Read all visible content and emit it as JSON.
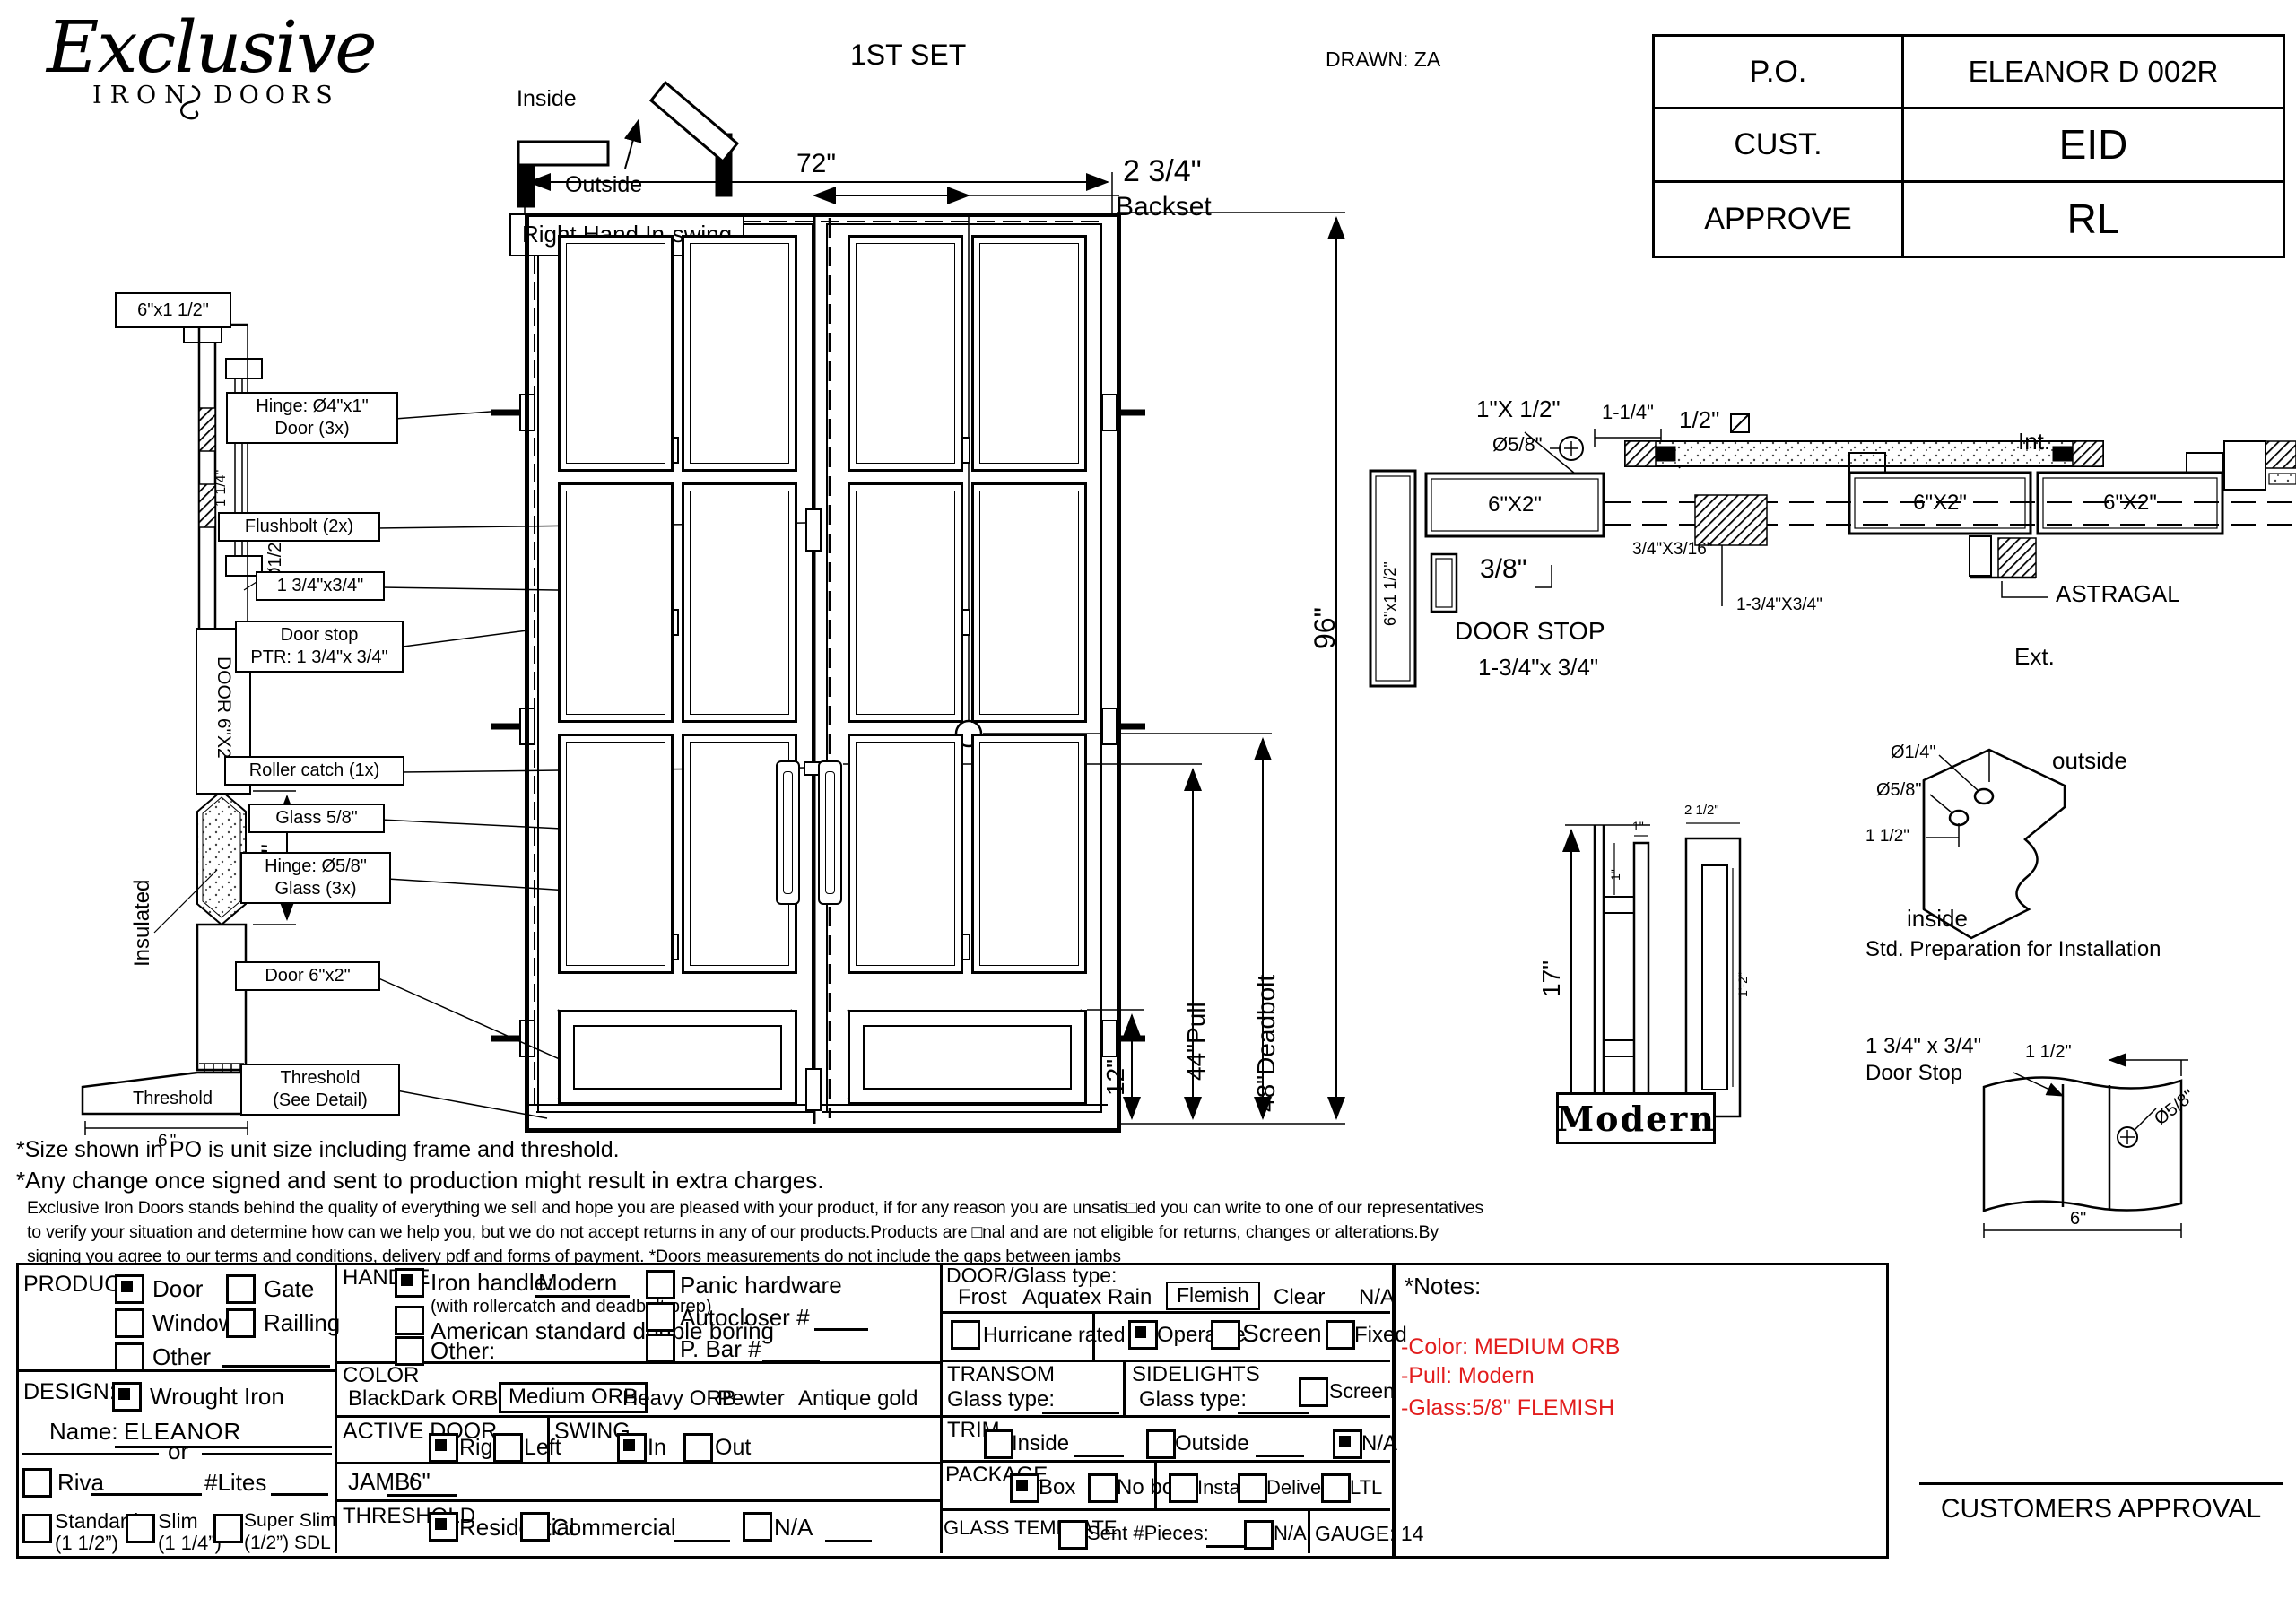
{
  "header": {
    "logo": {
      "script": "Exclusive",
      "word1": "IRON",
      "word2": "DOORS"
    },
    "set_label": "1ST SET",
    "drawn_label": "DRAWN: ZA",
    "po_table": {
      "rows": [
        {
          "label": "P.O.",
          "value": "ELEANOR D 002R"
        },
        {
          "label": "CUST.",
          "value": "EID"
        },
        {
          "label": "APPROVE",
          "value": "RL"
        }
      ]
    },
    "swing": {
      "inside": "Inside",
      "outside": "Outside",
      "caption": "Right Hand In-swing"
    }
  },
  "side_view": {
    "frame_label": "6\"x1 1/2\"",
    "dim_small": "1 1/4\"",
    "dim_dia": "Ø1/2\"",
    "door_label": "DOOR 6\"X2\"",
    "insulated_label": "Insulated",
    "dim_12": "12\"",
    "threshold_label": "Threshold",
    "threshold_dim": "6\""
  },
  "elevation": {
    "dim_width": "72\"",
    "backset_value": "2 3/4\"",
    "backset_label": "Backset",
    "dim_height": "96\"",
    "dim_deadbolt": "48\"Deadbolt",
    "dim_pull": "44\"Pull",
    "dim_bottom": "12\"",
    "callouts": [
      {
        "l1": "Hinge: Ø4\"x1\"",
        "l2": "Door (3x)"
      },
      {
        "l1": "Flushbolt (2x)",
        "l2": ""
      },
      {
        "l1": "1 3/4\"x3/4\"",
        "l2": ""
      },
      {
        "l1": "Door stop",
        "l2": "PTR: 1 3/4\"x 3/4\""
      },
      {
        "l1": "Roller catch  (1x)",
        "l2": ""
      },
      {
        "l1": "Glass 5/8\"",
        "l2": ""
      },
      {
        "l1": "Hinge: Ø5/8\"",
        "l2": "Glass (3x)"
      },
      {
        "l1": "Door 6\"x2\"",
        "l2": ""
      },
      {
        "l1": "Threshold",
        "l2": "(See Detail)"
      }
    ]
  },
  "plan_view": {
    "jamb_label": "6\"x1 1/2\"",
    "head_label": "6\"X2\"",
    "dim_1x": "1\"X 1/2\"",
    "dim_dia58": "Ø5/8\"",
    "dim_114": "1-1/4\"",
    "dim_half": "1/2\"",
    "dim_38": "3/8\"",
    "door_stop_l1": "DOOR STOP",
    "door_stop_l2": "1-3/4\"x 3/4\"",
    "dim_316": "3/4\"X3/16\"",
    "dim_134": "1-3/4\"X3/4\"",
    "int_label": "Int.",
    "ext_label": "Ext.",
    "leaf_label_left": "6\"X2\"",
    "leaf_label_right": "6\"X2\"",
    "astragal_label": "ASTRAGAL"
  },
  "pull_detail": {
    "dim_height": "17\"",
    "dim_one_a": "1\"",
    "dim_one_b": "1\"",
    "dim_width": "2 1/2\"",
    "dim_length": "1'-2\"",
    "name": "Modern"
  },
  "prep_detail": {
    "dia_small": "Ø1/4\"",
    "dia_big": "Ø5/8\"",
    "dim": "1 1/2\"",
    "outside": "outside",
    "inside": "inside",
    "caption": "Std. Preparation for Installation"
  },
  "stop_detail": {
    "label_l1": "1 3/4\" x 3/4\"",
    "label_l2": "Door Stop",
    "dim_a": "1 1/2\"",
    "dim_dia": "Ø5/8\"",
    "dim_w": "6\""
  },
  "disclaimers": {
    "line1": "*Size shown in PO is unit size including frame and threshold.",
    "line2": "*Any change once signed and sent to production might result in extra charges.",
    "para": "Exclusive Iron Doors stands behind the quality of everything we sell and hope you are pleased with your product, if for any reason you are unsatis□ed you can write to one of our representatives to verify your situation and determine how can we help you, but we do not accept returns in any of our products.Products are □nal and are not eligible for returns, changes or alterations.By signing you agree to our terms and conditions, delivery pdf and forms of payment. *Doors measurements do not include the gaps between jambs"
  },
  "form": {
    "product": {
      "title": "PRODUCT:",
      "door": {
        "label": "Door",
        "checked": true
      },
      "gate": {
        "label": "Gate",
        "checked": false
      },
      "window": {
        "label": "Window",
        "checked": false
      },
      "railling": {
        "label": "Railling",
        "checked": false
      },
      "other": {
        "label": "Other",
        "checked": false
      }
    },
    "design": {
      "title": "DESIGN:",
      "wrought": {
        "label": "Wrought Iron",
        "checked": true
      },
      "name_label": "Name:",
      "name_value": "ELEANOR",
      "or_label": "or",
      "riva": {
        "label": "Riva",
        "checked": false
      },
      "lites_label": "#Lites",
      "standard": {
        "l1": "Standard",
        "l2": "(1 1/2”)",
        "checked": false
      },
      "slim": {
        "l1": "Slim",
        "l2": "(1 1/4”)",
        "checked": false
      },
      "superslim": {
        "l1": "Super Slim",
        "l2": "(1/2”) SDL",
        "checked": false
      }
    },
    "handle": {
      "title": "HANDLE",
      "iron": {
        "label": "Iron handle:",
        "value": "Modern",
        "sub": "(with rollercatch and deadbolt prep)",
        "checked": true
      },
      "american": {
        "label": "American standard double boring",
        "checked": false
      },
      "other": {
        "label": "Other:",
        "checked": false
      },
      "panic": {
        "label": "Panic hardware",
        "checked": false
      },
      "autocloser": {
        "label": "Autocloser #",
        "checked": false
      },
      "pbar": {
        "label": "P. Bar #",
        "checked": false
      }
    },
    "color": {
      "title": "COLOR",
      "options": [
        "Black",
        "Dark ORB",
        "Medium ORB",
        "Heavy ORB",
        "Pewter",
        "Antique gold"
      ],
      "selected": "Medium ORB"
    },
    "active_door": {
      "title": "ACTIVE DOOR",
      "right": {
        "label": "Right",
        "checked": true
      },
      "left": {
        "label": "Left",
        "checked": false
      }
    },
    "swing": {
      "title": "SWING",
      "in": {
        "label": "In",
        "checked": true
      },
      "out": {
        "label": "Out",
        "checked": false
      }
    },
    "jamb": {
      "title": "JAMB:",
      "value": "6\""
    },
    "threshold": {
      "title": "THRESHOLD",
      "residential": {
        "label": "Residential",
        "checked": true
      },
      "commercial": {
        "label": "Commercial",
        "checked": false
      },
      "na": {
        "label": "N/A",
        "checked": false
      }
    },
    "glass": {
      "title": "DOOR/Glass type:",
      "options": [
        "Frost",
        "Aquatex",
        "Rain",
        "Flemish",
        "Clear",
        "N/A"
      ],
      "selected": "Flemish",
      "hurricane": {
        "label": "Hurricane rated",
        "checked": false
      },
      "operable": {
        "label": "Operable",
        "checked": true
      },
      "screen_or": {
        "label": "Screen or",
        "checked": false
      },
      "fixed": {
        "label": "Fixed",
        "checked": false
      }
    },
    "transom": {
      "title": "TRANSOM",
      "glass_label": "Glass type:"
    },
    "sidelights": {
      "title": "SIDELIGHTS",
      "glass_label": "Glass type:",
      "screen": {
        "label": "Screen",
        "checked": false
      }
    },
    "trim": {
      "title": "TRIM",
      "inside": {
        "label": "Inside",
        "checked": false
      },
      "outside": {
        "label": "Outside",
        "checked": false
      },
      "na": {
        "label": "N/A",
        "checked": true
      }
    },
    "package": {
      "title": "PACKAGE",
      "box": {
        "label": "Box",
        "checked": true
      },
      "nobox": {
        "label": "No box",
        "checked": false
      },
      "install": {
        "label": "Install",
        "checked": false
      },
      "delivery": {
        "label": "Delivery",
        "checked": false
      },
      "ltl": {
        "label": "LTL",
        "checked": false
      }
    },
    "glass_template": {
      "title": "GLASS TEMPLATE",
      "sent": {
        "label": "Sent #Pieces:",
        "checked": false
      },
      "na": {
        "label": "N/A",
        "checked": false
      },
      "gauge": "GAUGE: 14"
    }
  },
  "notes": {
    "title": "*Notes:",
    "lines": [
      "-Color: MEDIUM ORB",
      "-Pull: Modern",
      "-Glass:5/8\" FLEMISH"
    ],
    "text_color": "#e21d1d"
  },
  "approval_label": "CUSTOMERS APPROVAL"
}
